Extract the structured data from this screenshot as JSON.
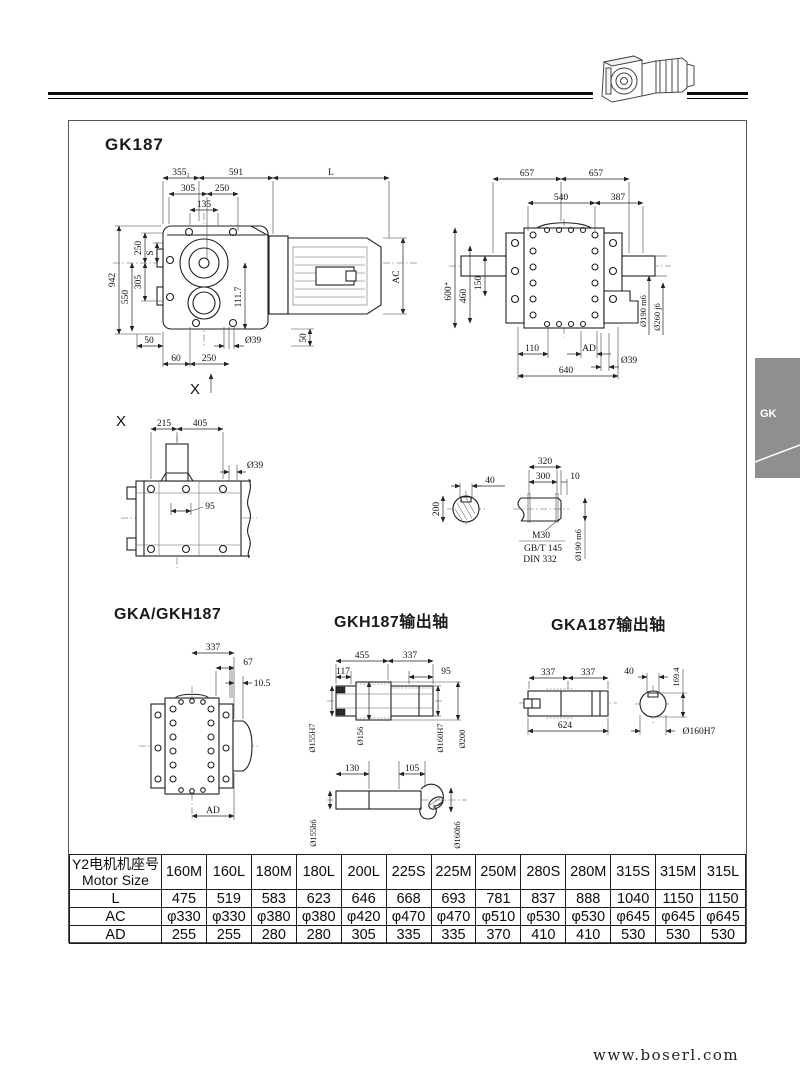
{
  "page": {
    "tab": "GK",
    "footer": "www.boserl.com"
  },
  "titles": {
    "main": "GK187",
    "gka_gkh": "GKA/GKH187",
    "gkh_shaft": "GKH187输出轴",
    "gka_shaft": "GKA187输出轴"
  },
  "front": {
    "d355": "355₁",
    "d591": "591",
    "L": "L",
    "d305t": "305",
    "d250t": "250",
    "d135": "135",
    "d250l": "250",
    "S": "S",
    "d305l": "305",
    "d550": "550",
    "d942": "942",
    "d50l": "50",
    "d60": "60",
    "d250b": "250",
    "d39": "Ø39",
    "d50r": "50",
    "d111": "111.7",
    "AC": "AC",
    "X": "X"
  },
  "side": {
    "d657a": "657",
    "d657b": "657",
    "d540": "540",
    "d387": "387",
    "d600": "600⁺",
    "d460": "460",
    "d150": "150",
    "d190": "Ø190 m6",
    "d260": "Ø260 j6",
    "d110": "110",
    "AD": "AD",
    "d39": "Ø39",
    "d640": "640"
  },
  "xview": {
    "X": "X",
    "d215": "215",
    "d405": "405",
    "d39": "Ø39",
    "d95": "95"
  },
  "shaft_sec": {
    "d40": "40",
    "d200": "200",
    "d320": "320",
    "d300": "300",
    "d10": "10",
    "m30": "M30",
    "gbt": "GB/T 145",
    "din": "DIN 332",
    "d190": "Ø190 m6"
  },
  "gkagkh": {
    "d337": "337",
    "d67": "67",
    "d105": "10.5",
    "AD": "AD"
  },
  "gkhshaft": {
    "d455": "455",
    "d337": "337",
    "d117": "117",
    "d95": "95",
    "d155H7": "Ø155H7",
    "d156": "Ø156",
    "d160H7": "Ø160H7",
    "d200": "Ø200",
    "d130": "130",
    "d105": "105",
    "d155h6": "Ø155h6",
    "d160h6": "Ø160h6"
  },
  "gkashaft": {
    "d337a": "337",
    "d337b": "337",
    "d624": "624",
    "d40": "40",
    "d1694": "169.4",
    "d160H7": "Ø160H7"
  },
  "table": {
    "header_cn": "Y2电机机座号",
    "header_en": "Motor Size",
    "columns": [
      "160M",
      "160L",
      "180M",
      "180L",
      "200L",
      "225S",
      "225M",
      "250M",
      "280S",
      "280M",
      "315S",
      "315M",
      "315L"
    ],
    "rows": [
      {
        "label": "L",
        "values": [
          "475",
          "519",
          "583",
          "623",
          "646",
          "668",
          "693",
          "781",
          "837",
          "888",
          "1040",
          "1150",
          "1150"
        ]
      },
      {
        "label": "AC",
        "values": [
          "φ330",
          "φ330",
          "φ380",
          "φ380",
          "φ420",
          "φ470",
          "φ470",
          "φ510",
          "φ530",
          "φ530",
          "φ645",
          "φ645",
          "φ645"
        ]
      },
      {
        "label": "AD",
        "values": [
          "255",
          "255",
          "280",
          "280",
          "305",
          "335",
          "335",
          "370",
          "410",
          "410",
          "530",
          "530",
          "530"
        ]
      }
    ]
  }
}
